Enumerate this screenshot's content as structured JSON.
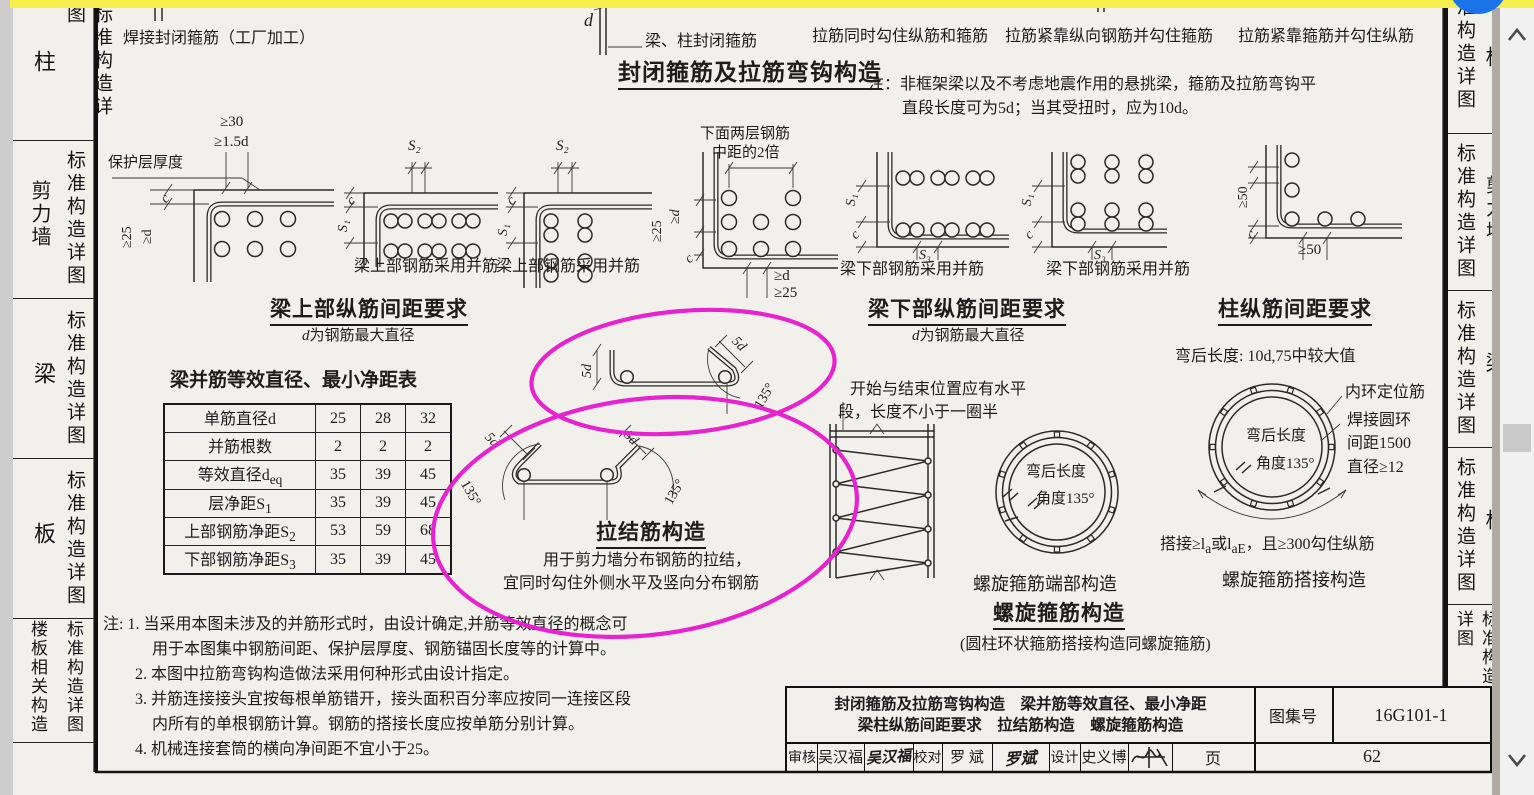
{
  "app": {
    "annotation_color": "#e623cf",
    "highlight_color": "#f5ef4e",
    "button_color": "#1a73e8"
  },
  "chrome": {
    "scroll_up_icon": "chevron-up",
    "scroll_down_icon": "chevron-down"
  },
  "sidebar_left": {
    "sections": [
      {
        "category": "柱",
        "label": "标准构造详图"
      },
      {
        "category": "剪力墙",
        "label": "标准构造详图"
      },
      {
        "category": "梁",
        "label": "标准构造详图"
      },
      {
        "category": "板",
        "label": "标准构造详图"
      },
      {
        "category": "楼板相关构造",
        "label": "标准构造详图"
      }
    ]
  },
  "sidebar_right": {
    "sections": [
      {
        "category": "柱",
        "label": "标准构造详图"
      },
      {
        "category": "剪力墙",
        "label": "标准构造详图"
      },
      {
        "category": "梁",
        "label": "标准构造详图"
      },
      {
        "category": "板",
        "label": "标准构造详图"
      },
      {
        "category": "楼板相关构造",
        "label": "标准构造详图"
      }
    ]
  },
  "header": {
    "weld_label": "焊接封闭箍筋（工厂加工）",
    "d_label": "d",
    "beam_col_stirrup": "梁、柱封闭箍筋",
    "tie_hook_both": "拉筋同时勾住纵筋和箍筋",
    "tie_near_long": "拉筋紧靠纵向钢筋并勾住箍筋",
    "tie_near_stirrup": "拉筋紧靠箍筋并勾住纵筋",
    "heading": "封闭箍筋及拉筋弯钩构造",
    "note1": "注：非框架梁以及不考虑地震作用的悬挑梁，箍筋及拉筋弯钩平",
    "note2": "直段长度可为5d；当其受扭时，应为10d。"
  },
  "dims": {
    "ge30": "≥30",
    "ge15d": "≥1.5d",
    "c": "c",
    "ge25": "≥25",
    "ged": "≥d",
    "s1": "S₁",
    "s2": "S₂",
    "s3": "S₃",
    "d": "d",
    "ge50": "≥50",
    "fived": "5d",
    "a135": "135°",
    "cover": "保护层厚度",
    "two1": "下面两层钢筋",
    "two2": "中距的2倍"
  },
  "captions": {
    "beam_top": "梁上部钢筋采用并筋",
    "beam_bottom": "梁下部钢筋采用并筋"
  },
  "sections": {
    "beam_top": {
      "title": "梁上部纵筋间距要求",
      "sub_d": "d",
      "sub_rest": "为钢筋最大直径"
    },
    "beam_bottom": {
      "title": "梁下部纵筋间距要求",
      "sub_d": "d",
      "sub_rest": "为钢筋最大直径"
    },
    "column": {
      "title": "柱纵筋间距要求"
    },
    "tie": {
      "title": "拉结筋构造",
      "sub1": "用于剪力墙分布钢筋的拉结，",
      "sub2": "宜同时勾住外侧水平及竖向分布钢筋"
    },
    "spiral": {
      "title": "螺旋箍筋构造",
      "subtitle": "(圆柱环状箍筋搭接构造同螺旋箍筋)",
      "end_cap": "螺旋箍筋端部构造",
      "lap_cap": "螺旋箍筋搭接构造",
      "start1": "开始与结束位置应有水平",
      "start2": "段，长度不小于一圈半",
      "bend": "弯后长度",
      "angle": "角度135°",
      "bend_rule": "弯后长度: 10d,75中较大值",
      "r1": "内环定位筋",
      "r2": "焊接圆环",
      "r3": "间距1500",
      "r4": "直径≥12",
      "lap1": "搭接≥l",
      "lap2": "a",
      "lap3": "或l",
      "lap4": "aE",
      "lap5": "，且≥300勾住纵筋"
    }
  },
  "table": {
    "title": "梁并筋等效直径、最小净距表",
    "rows": [
      {
        "label": "单筋直径d",
        "sub": "",
        "v": [
          "25",
          "28",
          "32"
        ]
      },
      {
        "label": "并筋根数",
        "sub": "",
        "v": [
          "2",
          "2",
          "2"
        ]
      },
      {
        "label": "等效直径d",
        "sub": "eq",
        "v": [
          "35",
          "39",
          "45"
        ]
      },
      {
        "label": "层净距S",
        "sub": "1",
        "v": [
          "35",
          "39",
          "45"
        ]
      },
      {
        "label": "上部钢筋净距S",
        "sub": "2",
        "v": [
          "53",
          "59",
          "68"
        ]
      },
      {
        "label": "下部钢筋净距S",
        "sub": "3",
        "v": [
          "35",
          "39",
          "45"
        ]
      }
    ]
  },
  "notes": {
    "n1": "注: 1. 当采用本图未涉及的并筋形式时，由设计确定,并筋等效直径的概念可",
    "n2": "用于本图集中钢筋间距、保护层厚度、钢筋锚固长度等的计算中。",
    "n3": "2. 本图中拉筋弯钩构造做法采用何种形式由设计指定。",
    "n4": "3. 并筋连接接头宜按每根单筋错开，接头面积百分率应按同一连接区段",
    "n5": "内所有的单根钢筋计算。钢筋的搭接长度应按单筋分别计算。",
    "n6": "4. 机械连接套筒的横向净间距不宜小于25。"
  },
  "titleblock": {
    "line1": "封闭箍筋及拉筋弯钩构造　梁并筋等效直径、最小净距",
    "line2": "梁柱纵筋间距要求　拉结筋构造　螺旋箍筋构造",
    "atlas_label": "图集号",
    "atlas_no": "16G101-1",
    "page_label": "页",
    "page_no": "62",
    "shenhe": "审核",
    "shenhe_name": "吴汉福",
    "shenhe_sig": "吴汉福",
    "jiaodui": "校对",
    "jiaodui_name": "罗 斌",
    "jiaodui_sig": "罗斌",
    "sheji": "设计",
    "sheji_name": "史义博"
  }
}
